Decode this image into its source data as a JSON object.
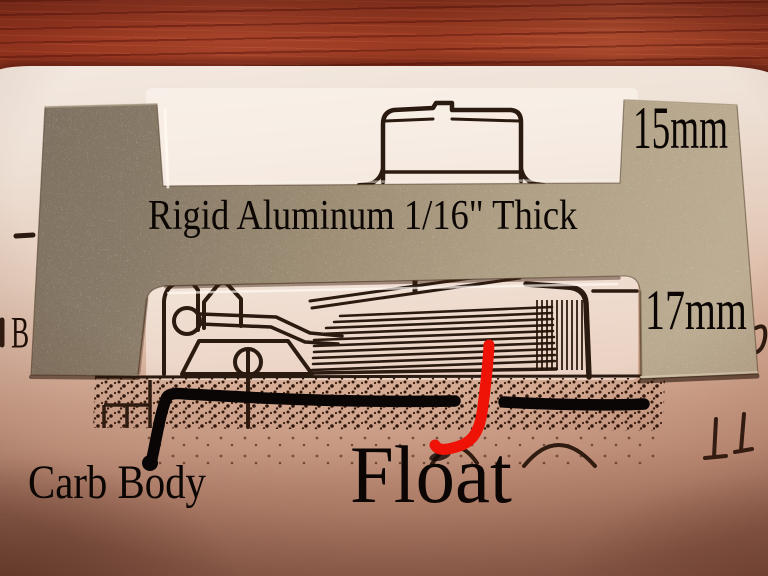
{
  "photo": {
    "labels": {
      "thickness_note": "Rigid Aluminum 1/16\" Thick",
      "top_step_dimension": "15mm",
      "bottom_step_dimension": "17mm",
      "carb_body": "Carb Body",
      "float": "Float",
      "paper_letter": "B"
    },
    "colors": {
      "wood": "#9d3a24",
      "paper_light": "#f2e8df",
      "paper_shadow": "#c6937c",
      "aluminum_light": "#bbac92",
      "aluminum_dark": "#7d7060",
      "diagram_ink": "#2b1a10",
      "annotation_black": "#0a0605",
      "annotation_red": "#ee1306"
    }
  }
}
